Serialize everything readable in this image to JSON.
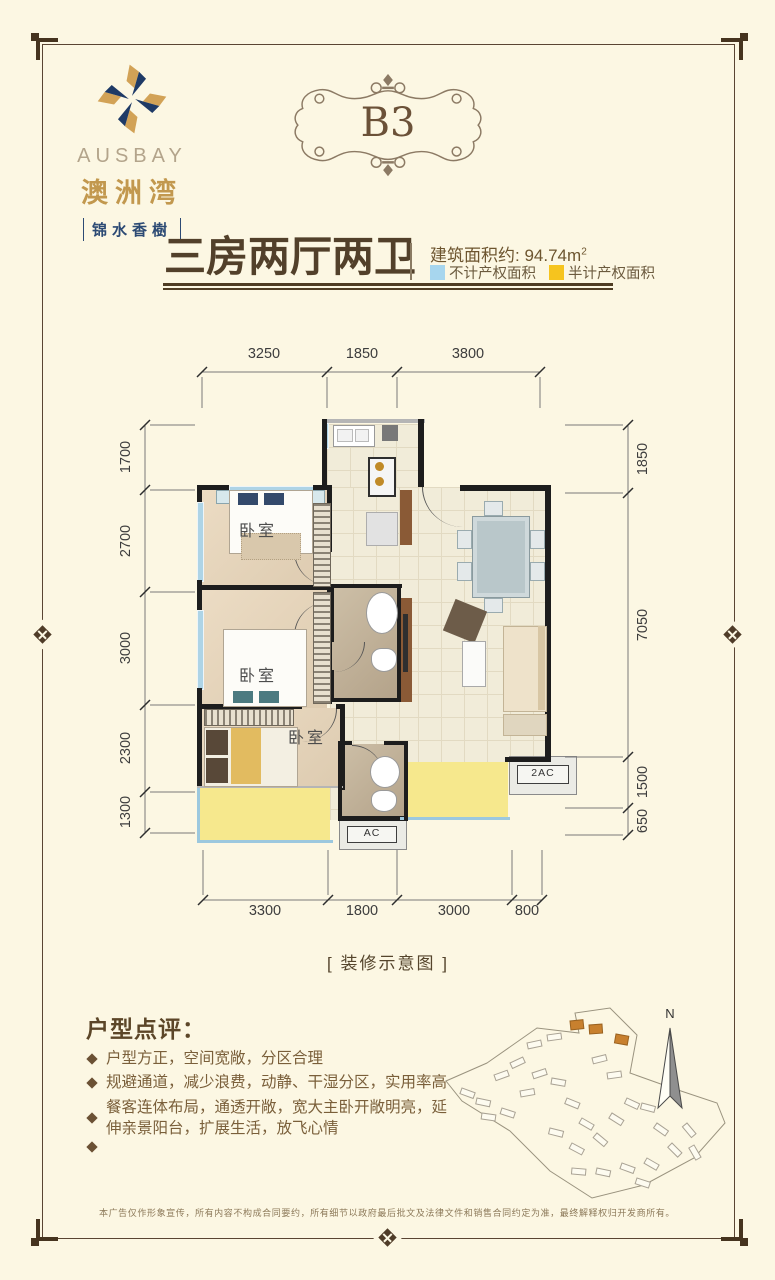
{
  "brand": {
    "name_en": "AUSBAY",
    "name_cn": "澳洲湾",
    "tagline": "锦水香樹",
    "colors": {
      "navy": "#2c4a74",
      "gold": "#c2984e"
    }
  },
  "badge": {
    "label": "B3"
  },
  "header": {
    "title": "三房两厅两卫",
    "area_label": "建筑面积约:",
    "area_value": "94.74",
    "area_unit": "m",
    "area_sup": "2",
    "legend": [
      {
        "label": "不计产权面积",
        "color": "#a7d6ee"
      },
      {
        "label": "半计产权面积",
        "color": "#f6c41e"
      }
    ]
  },
  "plan": {
    "caption": "[ 装修示意图 ]",
    "rooms": {
      "bedroom1": "卧室",
      "bedroom2": "卧室",
      "bedroom3": "卧室"
    },
    "ac": {
      "right": "2AC",
      "bottom": "AC"
    },
    "dims": {
      "top": [
        "3250",
        "1850",
        "3800"
      ],
      "left": [
        "1700",
        "2700",
        "3000",
        "2300",
        "1300"
      ],
      "right": [
        "1850",
        "7050",
        "1500",
        "650"
      ],
      "bottom": [
        "3300",
        "1800",
        "3000",
        "800"
      ]
    }
  },
  "review": {
    "title": "户型点评：",
    "bullets": [
      "户型方正，空间宽敞，分区合理",
      "规避通道，减少浪费，动静、干湿分区，实用率高",
      "餐客连体布局，通透开敞，宽大主卧开敞明亮，延伸亲景阳台，扩展生活，放飞心情",
      ""
    ]
  },
  "sitemap": {
    "compass_label": "N"
  },
  "footer": {
    "disclaimer": "本广告仅作形象宣传，所有内容不构成合同要约，所有细节以政府最后批文及法律文件和销售合同约定为准，最终解释权归开发商所有。"
  }
}
